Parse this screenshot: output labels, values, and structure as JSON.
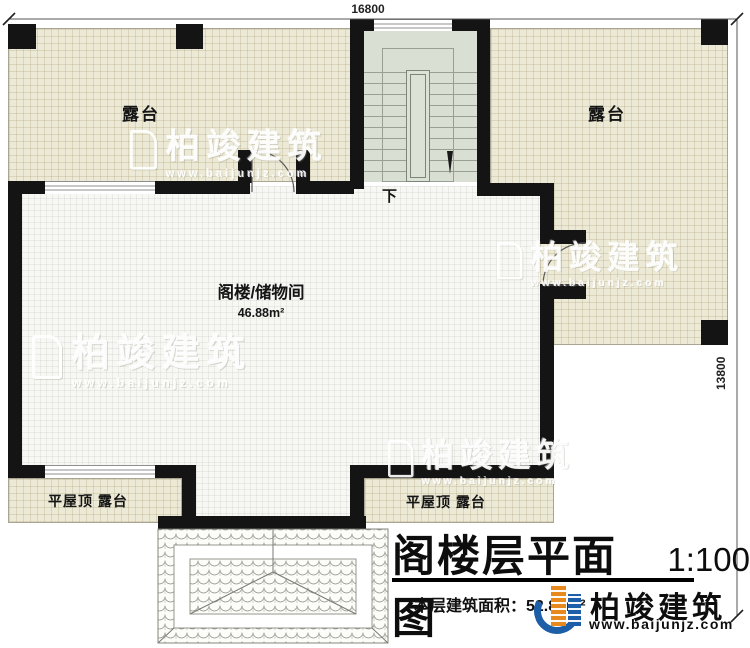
{
  "document": {
    "type": "floor-plan",
    "title": "阁楼层平面图",
    "scale": "1:100",
    "floor_area_note": "本层建筑面积：52.88m²"
  },
  "dimensions": {
    "top_width": "16800",
    "right_height": "13800"
  },
  "rooms": {
    "terrace_left": {
      "label": "露台"
    },
    "terrace_right": {
      "label": "露台"
    },
    "attic_storage": {
      "label": "阁楼/储物间",
      "area": "46.88m²"
    },
    "flat_roof_terrace_left": {
      "label": "平屋顶 露台"
    },
    "flat_roof_terrace_right": {
      "label": "平屋顶 露台"
    }
  },
  "stairs": {
    "direction_label": "下"
  },
  "brand": {
    "name": "柏竣建筑",
    "url": "www.baijunjz.com"
  },
  "watermark": {
    "name": "柏竣建筑",
    "url": "www.baijunjz.com"
  },
  "colors": {
    "wall": "#141414",
    "terrace_fill": "#ece9d6",
    "room_fill": "#f7f7f4",
    "stair_fill": "#dadfd3",
    "logo_blue": "#1c5fa8",
    "logo_orange": "#e8891d"
  }
}
